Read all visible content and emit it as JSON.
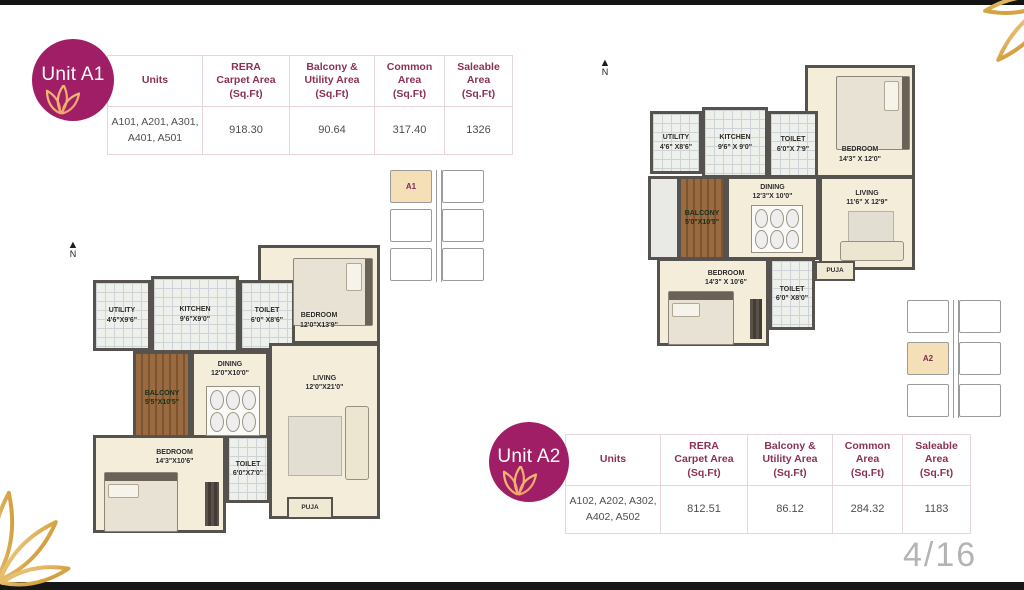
{
  "page": {
    "number": "4/16",
    "accent_color": "#a01e66",
    "gold_color": "#d9a33c",
    "north_label": "N"
  },
  "units": {
    "a1": {
      "badge_label": "Unit A1",
      "keyplan_label": "A1",
      "table": {
        "col_units": "Units",
        "col_rera": "RERA\nCarpet Area\n(Sq.Ft)",
        "col_balcony": "Balcony &\nUtility Area\n(Sq.Ft)",
        "col_common": "Common\nArea\n(Sq.Ft)",
        "col_saleable": "Saleable\nArea\n(Sq.Ft)",
        "row": {
          "units": "A101, A201, A301,\nA401, A501",
          "rera": "918.30",
          "balcony": "90.64",
          "common": "317.40",
          "saleable": "1326"
        }
      },
      "rooms": {
        "utility": "UTILITY\n4'6\"X9'6\"",
        "kitchen": "KITCHEN\n9'6\"X9'0\"",
        "toilet_top": "TOILET\n6'0\" X8'6\"",
        "bedroom_top": "BEDROOM\n12'0\"X13'9\"",
        "balcony": "BALCONY\n5'5\"X10'5\"",
        "dining": "DINING\n12'0\"X10'0\"",
        "living": "LIVING\n12'0\"X21'0\"",
        "bedroom_bottom": "BEDROOM\n14'3\"X10'6\"",
        "toilet_bottom": "TOILET\n6'0\"X7'0\"",
        "puja": "PUJA"
      }
    },
    "a2": {
      "badge_label": "Unit A2",
      "keyplan_label": "A2",
      "table": {
        "col_units": "Units",
        "col_rera": "RERA\nCarpet Area\n(Sq.Ft)",
        "col_balcony": "Balcony &\nUtility Area\n(Sq.Ft)",
        "col_common": "Common\nArea\n(Sq.Ft)",
        "col_saleable": "Saleable\nArea\n(Sq.Ft)",
        "row": {
          "units": "A102, A202, A302,\nA402, A502",
          "rera": "812.51",
          "balcony": "86.12",
          "common": "284.32",
          "saleable": "1183"
        }
      },
      "rooms": {
        "utility": "UTILITY\n4'6\" X8'6\"",
        "kitchen": "KITCHEN\n9'6\" X 9'0\"",
        "toilet_top": "TOILET\n6'0\"X 7'9\"",
        "bedroom_top": "BEDROOM\n14'3\" X 12'0\"",
        "balcony": "BALCONY\n5'0\"X10'5\"",
        "dining": "DINING\n12'3\"X 10'0\"",
        "living": "LIVING\n11'6\" X 12'9\"",
        "bedroom_bottom": "BEDROOM\n14'3\" X 10'6\"",
        "toilet_bottom": "TOILET\n6'0\" X8'0\"",
        "puja": "PUJA"
      }
    }
  }
}
